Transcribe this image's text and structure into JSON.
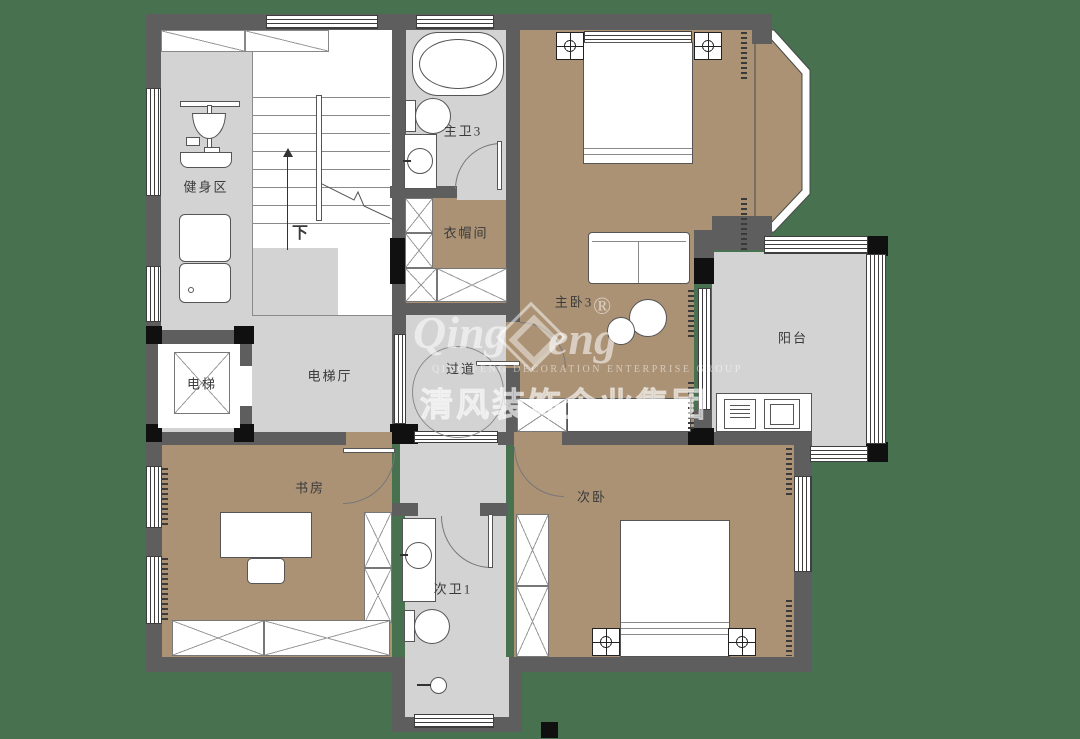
{
  "palette": {
    "background": "#47714F",
    "wall": "#5E5E5E",
    "column": "#101010",
    "floor_gray": "#D3D3D3",
    "floor_tan": "#AB9275",
    "fixture_white": "#FFFFFF"
  },
  "rooms": {
    "gym": {
      "label": "健身区"
    },
    "master_bath": {
      "label": "主卫3"
    },
    "cloakroom": {
      "label": "衣帽间"
    },
    "master_bedroom": {
      "label": "主卧3"
    },
    "balcony": {
      "label": "阳台"
    },
    "elevator": {
      "label": "电梯"
    },
    "elevator_hall": {
      "label": "电梯厅"
    },
    "corridor": {
      "label": "过道"
    },
    "study": {
      "label": "书房"
    },
    "second_bedroom": {
      "label": "次卧"
    },
    "second_bath": {
      "label": "次卫1"
    }
  },
  "stairs": {
    "down_label": "下"
  },
  "watermark": {
    "script_left": "Qing",
    "script_right": "eng",
    "registered": "®",
    "latin_line": "QING FENG   DECORATION   ENTERPRISE   GROUP",
    "chinese_line": "清风装饰企业集团"
  }
}
